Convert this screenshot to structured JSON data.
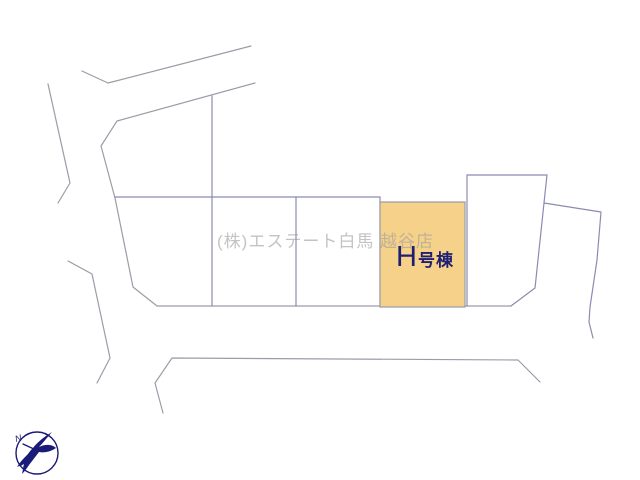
{
  "map": {
    "watermark_text": "(株)エステート白馬 越谷店",
    "highlighted_parcel": {
      "label": "H号棟",
      "label_prefix": "H",
      "label_suffix": "号棟"
    },
    "compass": {
      "north_label": "N"
    }
  },
  "colors": {
    "background": "#FFFFFF",
    "parcel_highlight_fill": "#F6D189",
    "parcel_line": "#8B8BB2",
    "road_line": "#9C9CA8",
    "label_navy": "#1F1F72",
    "watermark_gray": "#9E9E9E",
    "compass_navy": "#1A1A78"
  }
}
